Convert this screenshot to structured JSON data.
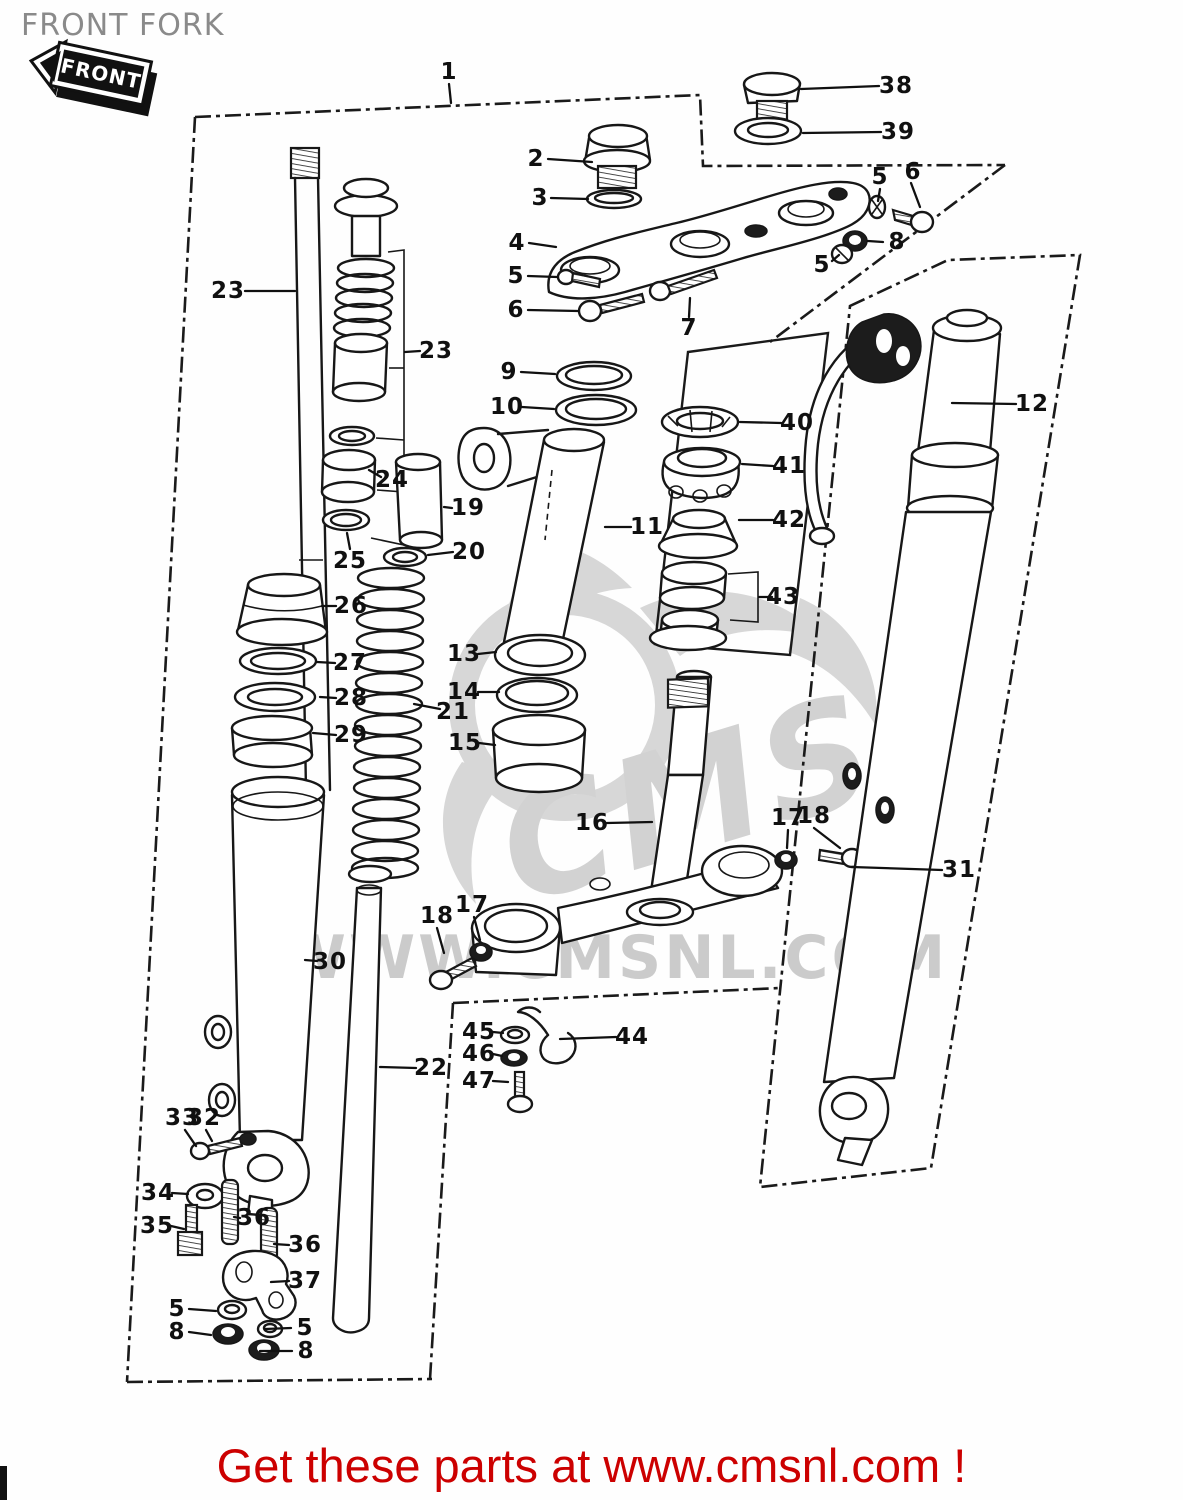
{
  "page": {
    "title": "FRONT FORK",
    "badge": "FRONT",
    "banner": "Get these parts at www.cmsnl.com !",
    "watermark": {
      "logo_text": "CMS",
      "url_text": "WWW.CMSNL.COM"
    },
    "colors": {
      "line": "#171717",
      "banner_red": "#cc0000",
      "title_gray": "#8a8a8a",
      "watermark_gray": "#d2d2d2",
      "background": "#ffffff"
    }
  },
  "diagram": {
    "description": "Exploded parts diagram of a motorcycle front fork with numbered part callouts",
    "labels": [
      {
        "id": "1",
        "text": "1",
        "x": 449,
        "y": 72,
        "leader": [
          449,
          84,
          451,
          103
        ]
      },
      {
        "id": "2",
        "text": "2",
        "x": 536,
        "y": 159,
        "leader": [
          548,
          159,
          592,
          162
        ]
      },
      {
        "id": "3",
        "text": "3",
        "x": 540,
        "y": 198,
        "leader": [
          551,
          198,
          588,
          199
        ]
      },
      {
        "id": "38",
        "text": "38",
        "x": 896,
        "y": 86,
        "leader": [
          879,
          86,
          801,
          89
        ]
      },
      {
        "id": "39",
        "text": "39",
        "x": 898,
        "y": 132,
        "leader": [
          881,
          132,
          803,
          133
        ]
      },
      {
        "id": "5-top",
        "text": "5",
        "x": 880,
        "y": 177,
        "leader": [
          880,
          189,
          878,
          201
        ]
      },
      {
        "id": "6-top",
        "text": "6",
        "x": 913,
        "y": 172,
        "leader": [
          911,
          183,
          920,
          207
        ]
      },
      {
        "id": "4",
        "text": "4",
        "x": 517,
        "y": 243,
        "leader": [
          529,
          243,
          556,
          247
        ]
      },
      {
        "id": "8-top",
        "text": "8",
        "x": 897,
        "y": 242,
        "leader": [
          883,
          242,
          868,
          241
        ]
      },
      {
        "id": "5-mid",
        "text": "5",
        "x": 822,
        "y": 265,
        "leader": [
          832,
          261,
          839,
          255
        ]
      },
      {
        "id": "5-left",
        "text": "5",
        "x": 516,
        "y": 276,
        "leader": [
          528,
          276,
          557,
          277
        ]
      },
      {
        "id": "6-left",
        "text": "6",
        "x": 516,
        "y": 310,
        "leader": [
          528,
          310,
          578,
          311
        ]
      },
      {
        "id": "7",
        "text": "7",
        "x": 689,
        "y": 328,
        "leader": [
          689,
          317,
          690,
          298
        ]
      },
      {
        "id": "23-left",
        "text": "23",
        "x": 228,
        "y": 291,
        "leader": [
          245,
          291,
          295,
          291
        ]
      },
      {
        "id": "23-right",
        "text": "23",
        "x": 436,
        "y": 351,
        "leader": [
          420,
          351,
          405,
          352
        ]
      },
      {
        "id": "9",
        "text": "9",
        "x": 509,
        "y": 372,
        "leader": [
          521,
          372,
          555,
          374
        ]
      },
      {
        "id": "10",
        "text": "10",
        "x": 507,
        "y": 407,
        "leader": [
          522,
          407,
          554,
          409
        ]
      },
      {
        "id": "40",
        "text": "40",
        "x": 797,
        "y": 423,
        "leader": [
          781,
          423,
          740,
          422
        ]
      },
      {
        "id": "41",
        "text": "41",
        "x": 789,
        "y": 466,
        "leader": [
          773,
          466,
          742,
          464
        ]
      },
      {
        "id": "42",
        "text": "42",
        "x": 789,
        "y": 520,
        "leader": [
          773,
          520,
          739,
          520
        ]
      },
      {
        "id": "24",
        "text": "24",
        "x": 392,
        "y": 480,
        "leader": [
          381,
          477,
          369,
          470
        ]
      },
      {
        "id": "19",
        "text": "19",
        "x": 468,
        "y": 508,
        "leader": [
          452,
          508,
          444,
          507
        ]
      },
      {
        "id": "25",
        "text": "25",
        "x": 350,
        "y": 561,
        "leader": [
          350,
          549,
          347,
          533
        ]
      },
      {
        "id": "20",
        "text": "20",
        "x": 469,
        "y": 552,
        "leader": [
          453,
          552,
          428,
          555
        ]
      },
      {
        "id": "43",
        "text": "43",
        "x": 783,
        "y": 597,
        "leader": [
          772,
          597,
          759,
          597
        ]
      },
      {
        "id": "26",
        "text": "26",
        "x": 351,
        "y": 606,
        "leader": [
          336,
          606,
          322,
          606
        ]
      },
      {
        "id": "11",
        "text": "11",
        "x": 647,
        "y": 527,
        "leader": [
          631,
          527,
          605,
          527
        ]
      },
      {
        "id": "12",
        "text": "12",
        "x": 1032,
        "y": 404,
        "leader": [
          1016,
          404,
          952,
          403
        ]
      },
      {
        "id": "27",
        "text": "27",
        "x": 350,
        "y": 663,
        "leader": [
          335,
          663,
          317,
          662
        ]
      },
      {
        "id": "28",
        "text": "28",
        "x": 351,
        "y": 698,
        "leader": [
          336,
          698,
          320,
          697
        ]
      },
      {
        "id": "13",
        "text": "13",
        "x": 464,
        "y": 654,
        "leader": [
          478,
          654,
          496,
          652
        ]
      },
      {
        "id": "14",
        "text": "14",
        "x": 464,
        "y": 692,
        "leader": [
          478,
          692,
          499,
          692
        ]
      },
      {
        "id": "21",
        "text": "21",
        "x": 453,
        "y": 712,
        "leader": [
          440,
          709,
          414,
          704
        ]
      },
      {
        "id": "29",
        "text": "29",
        "x": 351,
        "y": 735,
        "leader": [
          336,
          735,
          313,
          733
        ]
      },
      {
        "id": "15",
        "text": "15",
        "x": 465,
        "y": 743,
        "leader": [
          479,
          743,
          495,
          745
        ]
      },
      {
        "id": "16",
        "text": "16",
        "x": 592,
        "y": 823,
        "leader": [
          607,
          823,
          652,
          822
        ]
      },
      {
        "id": "17-right",
        "text": "17",
        "x": 788,
        "y": 818,
        "leader": [
          788,
          830,
          787,
          848
        ]
      },
      {
        "id": "18-right",
        "text": "18",
        "x": 814,
        "y": 816,
        "leader": [
          814,
          828,
          840,
          848
        ]
      },
      {
        "id": "31",
        "text": "31",
        "x": 959,
        "y": 870,
        "leader": [
          942,
          870,
          852,
          867
        ]
      },
      {
        "id": "18-left",
        "text": "18",
        "x": 437,
        "y": 916,
        "leader": [
          437,
          928,
          444,
          953
        ]
      },
      {
        "id": "17-left",
        "text": "17",
        "x": 472,
        "y": 905,
        "leader": [
          474,
          917,
          480,
          940
        ]
      },
      {
        "id": "30",
        "text": "30",
        "x": 330,
        "y": 962,
        "leader": [
          317,
          961,
          305,
          960
        ]
      },
      {
        "id": "22",
        "text": "22",
        "x": 431,
        "y": 1068,
        "leader": [
          416,
          1068,
          380,
          1067
        ]
      },
      {
        "id": "45",
        "text": "45",
        "x": 479,
        "y": 1032,
        "leader": [
          493,
          1032,
          503,
          1033
        ]
      },
      {
        "id": "46",
        "text": "46",
        "x": 479,
        "y": 1054,
        "leader": [
          493,
          1054,
          502,
          1056
        ]
      },
      {
        "id": "47",
        "text": "47",
        "x": 479,
        "y": 1081,
        "leader": [
          493,
          1081,
          508,
          1082
        ]
      },
      {
        "id": "44",
        "text": "44",
        "x": 632,
        "y": 1037,
        "leader": [
          616,
          1037,
          560,
          1039
        ]
      },
      {
        "id": "33",
        "text": "33",
        "x": 182,
        "y": 1118,
        "leader": [
          185,
          1130,
          196,
          1146
        ]
      },
      {
        "id": "32",
        "text": "32",
        "x": 204,
        "y": 1118,
        "leader": [
          206,
          1130,
          212,
          1141
        ]
      },
      {
        "id": "34",
        "text": "34",
        "x": 158,
        "y": 1193,
        "leader": [
          172,
          1193,
          188,
          1194
        ]
      },
      {
        "id": "35",
        "text": "35",
        "x": 157,
        "y": 1226,
        "leader": [
          171,
          1226,
          184,
          1229
        ]
      },
      {
        "id": "36-upper",
        "text": "36",
        "x": 254,
        "y": 1218,
        "leader": [
          240,
          1218,
          234,
          1217
        ]
      },
      {
        "id": "36-lower",
        "text": "36",
        "x": 305,
        "y": 1245,
        "leader": [
          289,
          1245,
          274,
          1244
        ]
      },
      {
        "id": "37",
        "text": "37",
        "x": 305,
        "y": 1281,
        "leader": [
          289,
          1281,
          271,
          1282
        ]
      },
      {
        "id": "5-bl1",
        "text": "5",
        "x": 177,
        "y": 1309,
        "leader": [
          189,
          1309,
          216,
          1311
        ]
      },
      {
        "id": "8-bl1",
        "text": "8",
        "x": 177,
        "y": 1332,
        "leader": [
          189,
          1332,
          211,
          1335
        ]
      },
      {
        "id": "5-bl2",
        "text": "5",
        "x": 305,
        "y": 1328,
        "leader": [
          291,
          1328,
          265,
          1329
        ]
      },
      {
        "id": "8-bl2",
        "text": "8",
        "x": 306,
        "y": 1351,
        "leader": [
          292,
          1351,
          260,
          1351
        ]
      }
    ]
  }
}
